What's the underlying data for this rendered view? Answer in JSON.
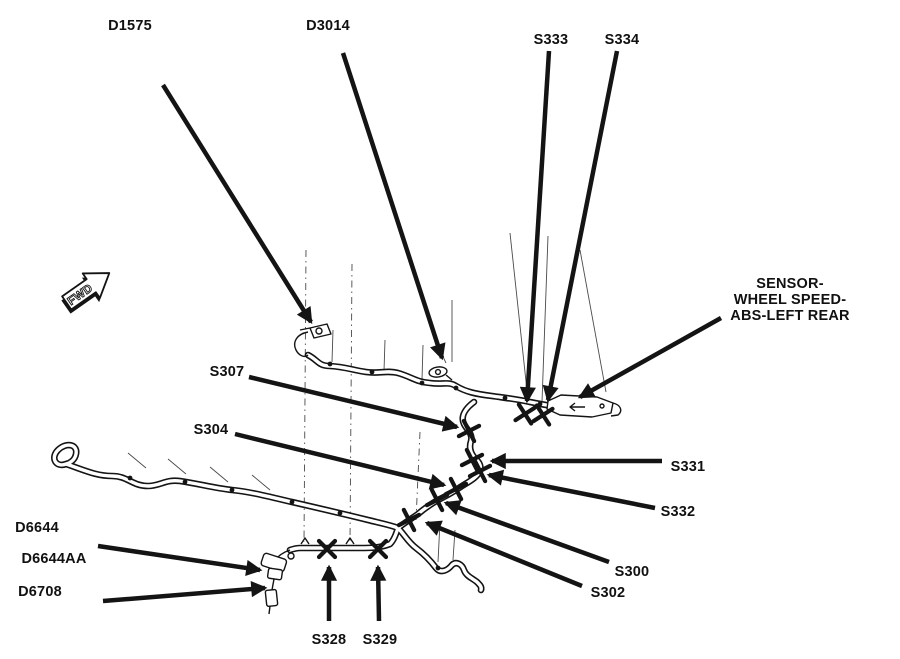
{
  "colors": {
    "background": "#ffffff",
    "ink": "#141414"
  },
  "connector_labels": {
    "d1575": "D1575",
    "d3014": "D3014",
    "d6644": "D6644",
    "d6644aa": "D6644AA",
    "d6708": "D6708"
  },
  "splice_labels": {
    "s300": "S300",
    "s302": "S302",
    "s304": "S304",
    "s307": "S307",
    "s328": "S328",
    "s329": "S329",
    "s331": "S331",
    "s332": "S332",
    "s333": "S333",
    "s334": "S334"
  },
  "component_labels": {
    "abs_sensor": {
      "line1": "SENSOR-",
      "line2": "WHEEL SPEED-",
      "line3": "ABS-LEFT REAR"
    }
  },
  "direction_marker": {
    "text": "FWD"
  }
}
